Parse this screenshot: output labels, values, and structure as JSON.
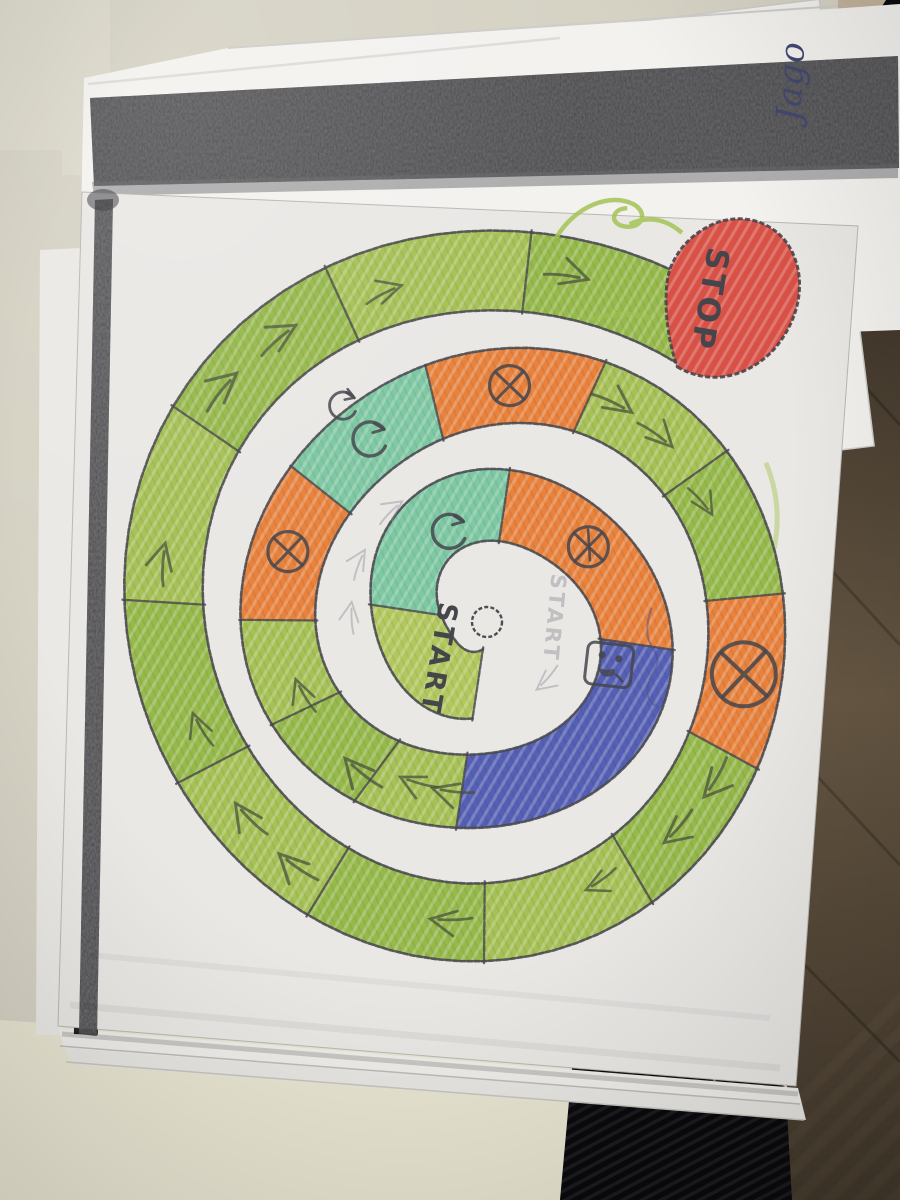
{
  "colors": {
    "wall": "#d6d3c5",
    "wall_light": "#dcd9cb",
    "table": "#e9e5d2",
    "wood": "#72614b",
    "wood_light": "#8d7a5e",
    "wood_dark": "#4c3f2f",
    "fabric_black": "#0a0a0c",
    "fabric_rib": "#1b1b20",
    "black_object": "#0c0c0e",
    "tan_sliver": "#c2b39c",
    "paper": "#eae8e5",
    "paper_top_sheet": "#f3f2ef",
    "paper_under": "#eeedea",
    "paper_strip": "#e7e6e2",
    "print_band": "#47474a",
    "pencil": "#45454c",
    "pencil_soft": "#8e8e96",
    "pen_blue": "#424870",
    "green_a": "#a6c156",
    "green_b": "#96b94b",
    "pie_green": "#b2c85e",
    "teal": "#7ec8a3",
    "orange": "#e8823c",
    "blue": "#5560b4",
    "red": "#d85146"
  },
  "handwriting": {
    "text": "Jago"
  },
  "board": {
    "start_label": "START",
    "start_ghost_label": "START",
    "stop_label": "STOP",
    "cells": [
      {
        "id": 0,
        "type": "start",
        "span_deg": 90,
        "symbol": null
      },
      {
        "id": 1,
        "type": "teal",
        "span_deg": 90,
        "symbol": "rotate-arrow"
      },
      {
        "id": 2,
        "type": "orange",
        "span_deg": 90,
        "symbol": "crossed-circle-spoked"
      },
      {
        "id": 3,
        "type": "blue",
        "span_deg": 90,
        "symbol": "die"
      },
      {
        "id": 4,
        "type": "green",
        "span_deg": 28,
        "symbol": null
      },
      {
        "id": 5,
        "type": "green",
        "span_deg": 28,
        "symbol": null
      },
      {
        "id": 6,
        "type": "green",
        "span_deg": 26,
        "symbol": null
      },
      {
        "id": 7,
        "type": "orange",
        "span_deg": 38,
        "symbol": "crossed-circle"
      },
      {
        "id": 8,
        "type": "teal",
        "span_deg": 38,
        "symbol": "rotate-arrow-double"
      },
      {
        "id": 9,
        "type": "orange",
        "span_deg": 38,
        "symbol": "crossed-circle"
      },
      {
        "id": 10,
        "type": "green",
        "span_deg": 30,
        "symbol": null
      },
      {
        "id": 11,
        "type": "green",
        "span_deg": 30,
        "symbol": null
      },
      {
        "id": 12,
        "type": "orange",
        "span_deg": 34,
        "symbol": "crossed-circle-large"
      },
      {
        "id": 13,
        "type": "green",
        "span_deg": 31,
        "symbol": null
      },
      {
        "id": 14,
        "type": "green",
        "span_deg": 31,
        "symbol": null
      },
      {
        "id": 15,
        "type": "green",
        "span_deg": 31,
        "symbol": null
      },
      {
        "id": 16,
        "type": "green",
        "span_deg": 31,
        "symbol": null
      },
      {
        "id": 17,
        "type": "green",
        "span_deg": 31,
        "symbol": null
      },
      {
        "id": 18,
        "type": "green",
        "span_deg": 31,
        "symbol": null
      },
      {
        "id": 19,
        "type": "green",
        "span_deg": 31,
        "symbol": null
      },
      {
        "id": 20,
        "type": "green",
        "span_deg": 31,
        "symbol": null
      },
      {
        "id": 21,
        "type": "green",
        "span_deg": 30,
        "symbol": null
      }
    ]
  }
}
